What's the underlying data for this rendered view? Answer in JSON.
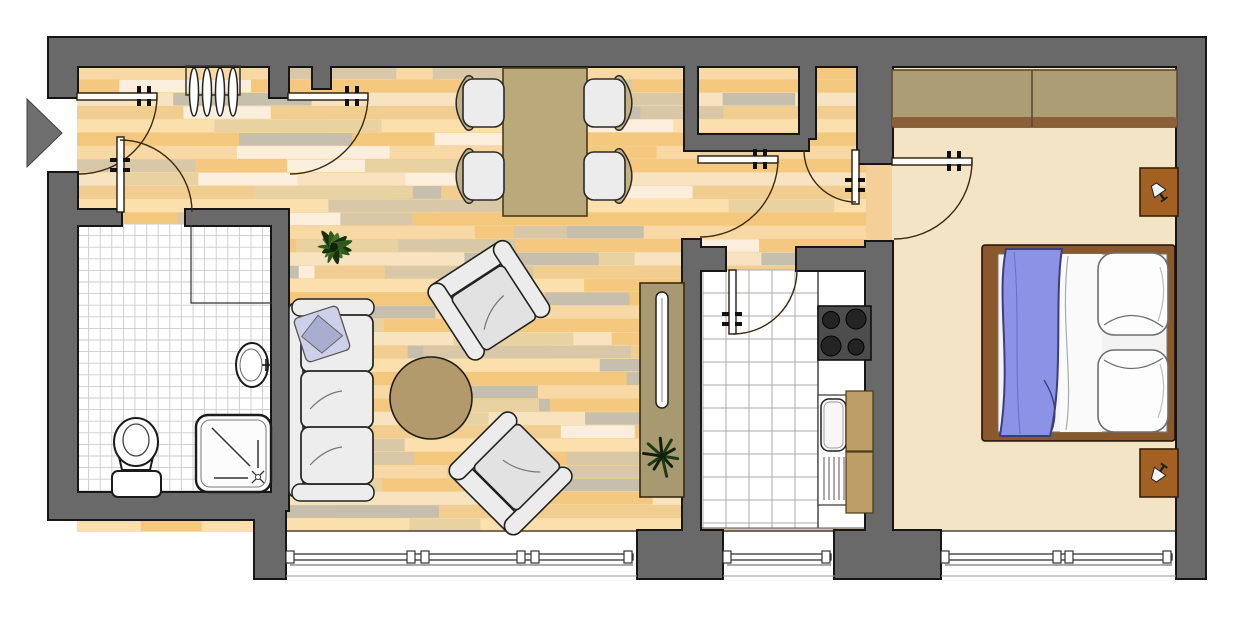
{
  "document": {
    "type": "apartment-floor-plan",
    "visible_text": [],
    "orientation": "landscape"
  },
  "palette": {
    "page_background": "#ffffff",
    "wall_fill": "#696969",
    "wall_outline": "#161616",
    "entrance_arrow": "#6f6f6f",
    "parquet_rows": [
      "#f8d9a6",
      "#f4c87e",
      "#f7e3c0",
      "#f2cd90",
      "#fbe0ae",
      "#f3c77c"
    ],
    "parquet_planks": [
      "#c7bfae",
      "#f4c87e",
      "#fceedd",
      "#e9d2a2",
      "#d8c8a8"
    ],
    "doorway_patch": "#f4d098",
    "tile_floor": "#ffffff",
    "bath_tile_line": "#cbcbcb",
    "kitchen_tile_line": "#ababab",
    "bedroom_floor": "#f4e4c6",
    "door_leaf": "#ffffff",
    "door_line": "#3a2a10",
    "door_bracket": "#111111",
    "fixture_stroke": "#1b1b1b",
    "fixture_fill": "#ffffff",
    "table": "#b9a97b",
    "table_outline": "#4a3a1a",
    "chair_seat": "#ececec",
    "chair_back": "#c3b183",
    "sofa": "#ededed",
    "sofa_outline": "#222222",
    "sofa_pillow": "#ccd0e8",
    "sofa_pillow_shade": "#a9aed0",
    "rug": "#b29a6c",
    "sideboard": "#a89a70",
    "tv": "#ffffff",
    "plant_dark": "#16300f",
    "plant_mid": "#2e5a1c",
    "plant_light": "#447326",
    "counter": "#ffffff",
    "stove": "#4d4d4d",
    "burner": "#242424",
    "cabinet": "#bf9d66",
    "wardrobe": "#ad9d75",
    "wardrobe_shadow": "#8b6039",
    "wardrobe_outline": "#5f4a28",
    "bed_frame": "#8a592b",
    "mattress": "#f3f3f3",
    "blanket": "#8c93e6",
    "blanket_line": "#3c3f7a",
    "pillow": "#fdfdfd",
    "pillow_line": "#6e6e6e",
    "nightstand": "#a26122",
    "lamp": "#f5f5f5",
    "window_line": "#333333",
    "window_sill": "#999999"
  },
  "scene": {
    "entrance": {
      "items": [
        {
          "name": "entrance-arrow",
          "count": 1
        },
        {
          "name": "entrance-door",
          "count": 1
        }
      ]
    },
    "hall": {
      "items": [
        {
          "name": "coat-rack-with-hangers",
          "count": 1
        },
        {
          "name": "hall-living-door",
          "count": 1
        },
        {
          "name": "bathroom-door",
          "count": 1
        }
      ]
    },
    "bathroom": {
      "items": [
        {
          "name": "washbasin",
          "count": 1
        },
        {
          "name": "toilet",
          "count": 1
        },
        {
          "name": "shower",
          "count": 1
        },
        {
          "name": "privacy-screen",
          "count": 1
        }
      ]
    },
    "living_room": {
      "items": [
        {
          "name": "dining-table",
          "count": 1
        },
        {
          "name": "dining-chair",
          "count": 4
        },
        {
          "name": "sofa",
          "count": 1
        },
        {
          "name": "sofa-pillow",
          "count": 1
        },
        {
          "name": "armchair",
          "count": 2
        },
        {
          "name": "round-rug",
          "count": 1
        },
        {
          "name": "palm-plant",
          "count": 1
        },
        {
          "name": "sideboard",
          "count": 1
        },
        {
          "name": "tv",
          "count": 1
        },
        {
          "name": "small-plant",
          "count": 1
        }
      ]
    },
    "corridor": {
      "items": [
        {
          "name": "living-corridor-door",
          "count": 1
        },
        {
          "name": "closet-door",
          "count": 1
        }
      ]
    },
    "kitchen": {
      "items": [
        {
          "name": "kitchen-door",
          "count": 1
        },
        {
          "name": "stove",
          "count": 1
        },
        {
          "name": "kitchen-sink",
          "count": 1
        },
        {
          "name": "cabinet",
          "count": 2
        },
        {
          "name": "counter",
          "count": 1
        }
      ]
    },
    "bedroom": {
      "items": [
        {
          "name": "bedroom-door",
          "count": 1
        },
        {
          "name": "wardrobe",
          "count": 1
        },
        {
          "name": "double-bed",
          "count": 1
        },
        {
          "name": "blanket",
          "count": 1
        },
        {
          "name": "bed-pillow",
          "count": 2
        },
        {
          "name": "nightstand",
          "count": 2
        },
        {
          "name": "table-lamp",
          "count": 2
        }
      ]
    },
    "windows": {
      "count": 3
    }
  }
}
